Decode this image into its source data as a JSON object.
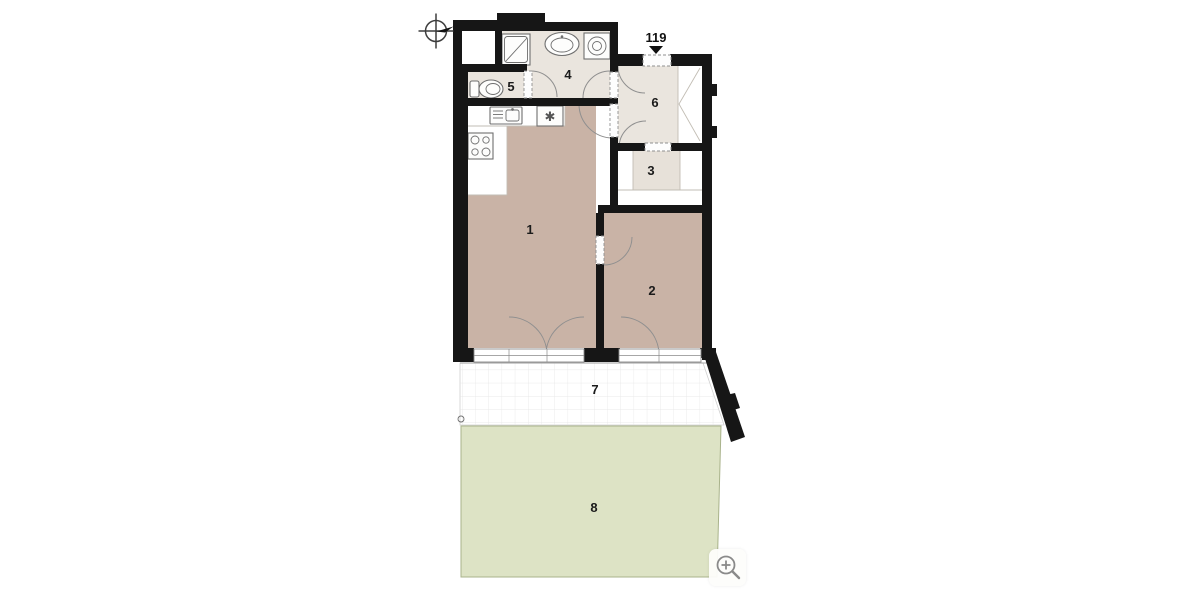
{
  "plan": {
    "unit_label": "119",
    "rooms": [
      {
        "number": "1"
      },
      {
        "number": "2"
      },
      {
        "number": "3"
      },
      {
        "number": "4"
      },
      {
        "number": "5"
      },
      {
        "number": "6"
      },
      {
        "number": "7"
      },
      {
        "number": "8"
      }
    ],
    "symbols": {
      "appliance_marker": "✱"
    },
    "colors": {
      "wall": "#161616",
      "room-main": "#c9b3a6",
      "room-light": "#eae5de",
      "room-mid": "#e7e1d9",
      "garden": "#dde3c5",
      "garden-border": "#a9b38b",
      "terrace-grid": "#e4e4e4",
      "line": "#8f8f8f",
      "outline": "#6f6f6f"
    }
  },
  "controls": {
    "zoom_button_icon": "magnifier-plus-icon"
  }
}
